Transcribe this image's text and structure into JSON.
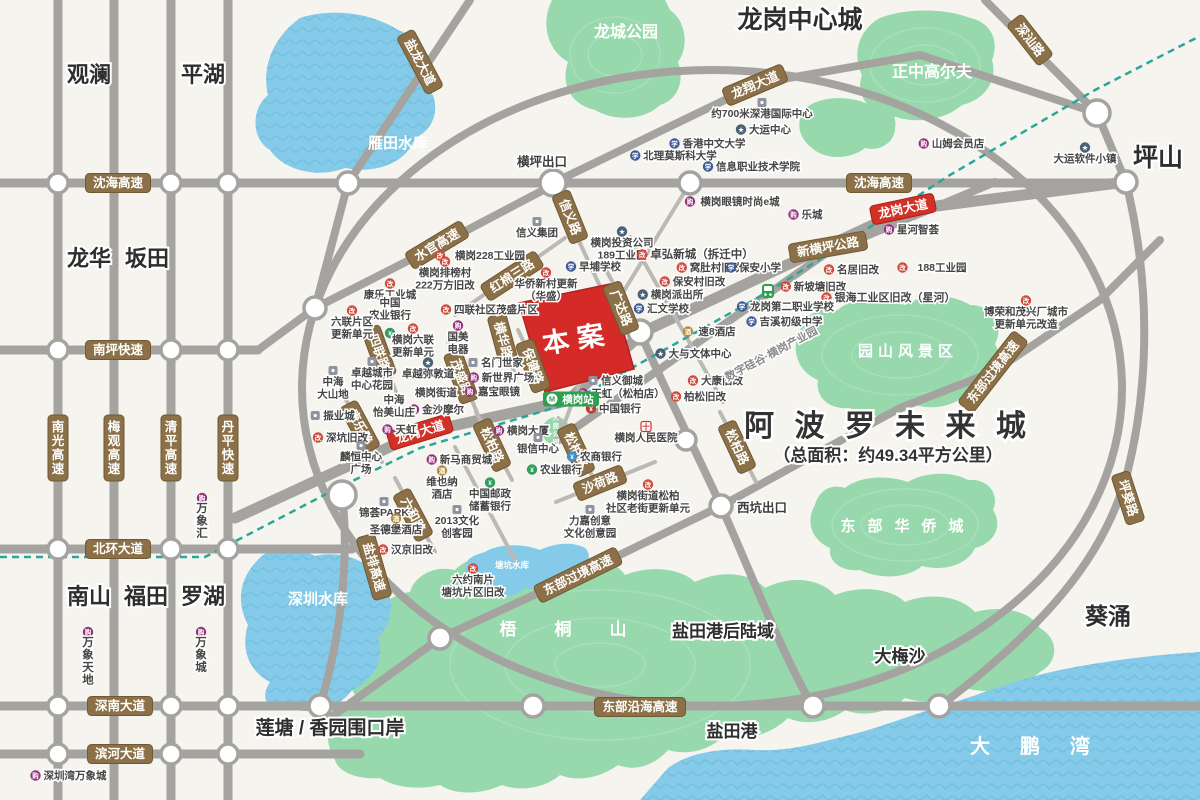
{
  "apollo": {
    "title": "阿 波 罗 未 来 城",
    "subtitle": "（总面积：约49.34平方公里）"
  },
  "site": {
    "label": "本案"
  },
  "station": {
    "label": "横岗站"
  },
  "districts": [
    {
      "t": "观澜",
      "x": 89,
      "y": 82,
      "fs": 22
    },
    {
      "t": "平湖",
      "x": 203,
      "y": 82,
      "fs": 22
    },
    {
      "t": "龙岗中心城",
      "x": 800,
      "y": 28,
      "fs": 25
    },
    {
      "t": "坪山",
      "x": 1158,
      "y": 166,
      "fs": 25
    },
    {
      "t": "龙华",
      "x": 89,
      "y": 266,
      "fs": 22
    },
    {
      "t": "坂田",
      "x": 147,
      "y": 266,
      "fs": 22
    },
    {
      "t": "南山",
      "x": 89,
      "y": 604,
      "fs": 22
    },
    {
      "t": "福田",
      "x": 146,
      "y": 604,
      "fs": 22
    },
    {
      "t": "罗湖",
      "x": 203,
      "y": 604,
      "fs": 22
    },
    {
      "t": "葵涌",
      "x": 1108,
      "y": 624,
      "fs": 23
    },
    {
      "t": "大梅沙",
      "x": 900,
      "y": 662,
      "fs": 17
    },
    {
      "t": "盐田港后陆域",
      "x": 723,
      "y": 637,
      "fs": 17
    },
    {
      "t": "盐田港",
      "x": 732,
      "y": 737,
      "fs": 17
    },
    {
      "t": "莲塘 / 香园围口岸",
      "x": 330,
      "y": 734,
      "fs": 19
    }
  ],
  "water_labels": [
    {
      "t": "雁田水库",
      "x": 398,
      "y": 148,
      "fs": 15
    },
    {
      "t": "深圳水库",
      "x": 318,
      "y": 604,
      "fs": 15
    },
    {
      "t": "塘坑水库",
      "x": 512,
      "y": 568,
      "fs": 8.5
    },
    {
      "t": "大鹏湾",
      "x": 1045,
      "y": 753,
      "fs": 20,
      "ls": 30
    }
  ],
  "park_labels": [
    {
      "t": "龙城公园",
      "x": 626,
      "y": 37,
      "fs": 16
    },
    {
      "t": "正中高尔夫",
      "x": 932,
      "y": 77,
      "fs": 16
    },
    {
      "t": "园山风景区",
      "x": 908,
      "y": 356,
      "fs": 15,
      "ls": 5
    },
    {
      "t": "东部华侨城",
      "x": 908,
      "y": 531,
      "fs": 15,
      "ls": 12
    },
    {
      "t": "梧桐山",
      "x": 582,
      "y": 635,
      "fs": 17,
      "ls": 38
    },
    {
      "t": "人民公园",
      "x": 556,
      "y": 420,
      "fs": 6.5,
      "vert": 1
    }
  ],
  "road_labels": [
    {
      "t": "沈海高速",
      "x": 118,
      "y": 183
    },
    {
      "t": "沈海高速",
      "x": 879,
      "y": 183
    },
    {
      "t": "南坪快速",
      "x": 118,
      "y": 350
    },
    {
      "t": "北环大道",
      "x": 118,
      "y": 549
    },
    {
      "t": "深南大道",
      "x": 120,
      "y": 706
    },
    {
      "t": "滨河大道",
      "x": 120,
      "y": 754
    },
    {
      "t": "东部沿海高速",
      "x": 640,
      "y": 707
    },
    {
      "t": "新横坪公路",
      "x": 828,
      "y": 247,
      "rot": -10
    },
    {
      "t": "盐龙大道",
      "x": 420,
      "y": 62,
      "rot": 62
    },
    {
      "t": "龙翔大道",
      "x": 755,
      "y": 85,
      "rot": -23
    },
    {
      "t": "深汕路",
      "x": 1030,
      "y": 40,
      "rot": 52
    },
    {
      "t": "水官高速",
      "x": 437,
      "y": 245,
      "rot": -31
    },
    {
      "t": "红棉三路",
      "x": 512,
      "y": 276,
      "rot": -33
    },
    {
      "t": "信义路",
      "x": 570,
      "y": 217,
      "rot": 68
    },
    {
      "t": "横华路",
      "x": 503,
      "y": 340,
      "rot": 75
    },
    {
      "t": "茂盛路",
      "x": 461,
      "y": 377,
      "rot": 70
    },
    {
      "t": "四联路",
      "x": 379,
      "y": 352,
      "rot": 70
    },
    {
      "t": "康乐路",
      "x": 360,
      "y": 427,
      "rot": 62
    },
    {
      "t": "六和路",
      "x": 413,
      "y": 515,
      "rot": 62
    },
    {
      "t": "保健路",
      "x": 533,
      "y": 366,
      "rot": 70
    },
    {
      "t": "广达路",
      "x": 621,
      "y": 308,
      "rot": 68
    },
    {
      "t": "松柏路",
      "x": 492,
      "y": 445,
      "rot": 65
    },
    {
      "t": "松柏路",
      "x": 576,
      "y": 450,
      "rot": 65
    },
    {
      "t": "松柏路",
      "x": 737,
      "y": 447,
      "rot": 65
    },
    {
      "t": "沙荷路",
      "x": 600,
      "y": 483,
      "rot": -22
    },
    {
      "t": "盐排高速",
      "x": 374,
      "y": 567,
      "rot": 74
    },
    {
      "t": "东部过境高速",
      "x": 578,
      "y": 575,
      "rot": -26
    },
    {
      "t": "东部过境高速",
      "x": 993,
      "y": 372,
      "rot": -52
    },
    {
      "t": "坪葵路",
      "x": 1128,
      "y": 498,
      "rot": 72
    },
    {
      "t": "南光高速",
      "x": 58,
      "y": 448,
      "v": 1
    },
    {
      "t": "梅观高速",
      "x": 114,
      "y": 448,
      "v": 1
    },
    {
      "t": "清平高速",
      "x": 171,
      "y": 448,
      "v": 1
    },
    {
      "t": "丹平快速",
      "x": 228,
      "y": 448,
      "v": 1
    },
    {
      "t": "龙岗大道",
      "x": 420,
      "y": 432,
      "rot": -17,
      "style": "red"
    },
    {
      "t": "龙岗大道",
      "x": 903,
      "y": 209,
      "rot": -12,
      "style": "red"
    }
  ],
  "exits": [
    {
      "t": "横坪出口",
      "x": 542,
      "y": 166
    },
    {
      "t": "西坑出口",
      "x": 762,
      "y": 512
    }
  ],
  "pois": [
    {
      "x": 762,
      "y": 117,
      "t": "约700米深港国际中心",
      "icon": "building",
      "ic": "a"
    },
    {
      "x": 770,
      "y": 133,
      "t": "大运中心",
      "icon": "spot"
    },
    {
      "x": 714,
      "y": 147,
      "t": "香港中文大学",
      "icon": "school"
    },
    {
      "x": 680,
      "y": 159,
      "t": "北理莫斯科大学",
      "icon": "school"
    },
    {
      "x": 758,
      "y": 170,
      "t": "信息职业技术学院",
      "icon": "school"
    },
    {
      "x": 740,
      "y": 205,
      "t": "横岗眼镜时尚e城",
      "icon": "mall"
    },
    {
      "x": 812,
      "y": 218,
      "t": "乐城",
      "icon": "mall"
    },
    {
      "x": 918,
      "y": 233,
      "t": "星河智荟",
      "icon": "mall"
    },
    {
      "x": 958,
      "y": 147,
      "t": "山姆会员店",
      "icon": "mall"
    },
    {
      "x": 1085,
      "y": 162,
      "t": "大运软件小镇",
      "icon": "spot",
      "ic": "a"
    },
    {
      "x": 1026,
      "y": 315,
      "lines": [
        "博荣和茂兴厂城市",
        "更新单元改造"
      ],
      "icon": "redev",
      "ic": "a"
    },
    {
      "x": 537,
      "y": 236,
      "t": "信义集团",
      "icon": "building",
      "ic": "a"
    },
    {
      "x": 622,
      "y": 246,
      "lines": [
        "横岗投资公司",
        "189工业区"
      ],
      "icon": "spot",
      "ic": "a"
    },
    {
      "x": 702,
      "y": 258,
      "t": "卓弘新城（拆迁中）",
      "fs": 11.5,
      "icon": "redev"
    },
    {
      "x": 490,
      "y": 259,
      "t": "横岗228工业园",
      "icon": "redev"
    },
    {
      "x": 600,
      "y": 270,
      "t": "早埔学校",
      "icon": "school"
    },
    {
      "x": 716,
      "y": 271,
      "t": "窝肚村旧改",
      "icon": "redev"
    },
    {
      "x": 445,
      "y": 276,
      "lines": [
        "横岗排榜村",
        "222万方旧改"
      ],
      "icon": "redev",
      "ic": "a"
    },
    {
      "x": 760,
      "y": 271,
      "t": "保安小学",
      "icon": "school"
    },
    {
      "x": 699,
      "y": 285,
      "t": "保安村旧改",
      "icon": "redev"
    },
    {
      "x": 858,
      "y": 273,
      "t": "名居旧改",
      "icon": "redev"
    },
    {
      "x": 942,
      "y": 271,
      "t": "188工业园",
      "icon": "redev"
    },
    {
      "x": 390,
      "y": 298,
      "t": "康乐工业城",
      "icon": "redev",
      "ic": "a"
    },
    {
      "x": 390,
      "y": 306,
      "lines": [
        "中国",
        "农业银行"
      ],
      "icon": "bank-green",
      "ic": "b"
    },
    {
      "x": 352,
      "y": 325,
      "lines": [
        "六联片区",
        "更新单元"
      ],
      "icon": "redev",
      "ic": "a"
    },
    {
      "x": 413,
      "y": 343,
      "lines": [
        "横岗六联",
        "更新单元"
      ],
      "icon": "redev",
      "ic": "a"
    },
    {
      "x": 496,
      "y": 313,
      "t": "四联社区茂盛片区",
      "icon": "redev"
    },
    {
      "x": 546,
      "y": 287,
      "lines": [
        "华侨新村更新",
        "（华盛）"
      ],
      "icon": "redev",
      "ic": "a"
    },
    {
      "x": 458,
      "y": 340,
      "lines": [
        "国美",
        "电器"
      ],
      "icon": "mall",
      "ic": "a"
    },
    {
      "x": 502,
      "y": 366,
      "t": "名门世家",
      "icon": "building"
    },
    {
      "x": 508,
      "y": 381,
      "t": "新世界广场",
      "icon": "mall"
    },
    {
      "x": 499,
      "y": 395,
      "t": "嘉宝眼镜",
      "icon": "mall"
    },
    {
      "x": 372,
      "y": 376,
      "lines": [
        "卓越城市",
        "中心花园"
      ],
      "icon": "building",
      "ic": "a"
    },
    {
      "x": 333,
      "y": 385,
      "lines": [
        "中海",
        "大山地"
      ],
      "icon": "building",
      "ic": "a"
    },
    {
      "x": 428,
      "y": 377,
      "t": "卓越弥敦道",
      "icon": "spot",
      "ic": "a"
    },
    {
      "x": 436,
      "y": 396,
      "t": "横岗街道",
      "icon": "none",
      "fs": 10.5
    },
    {
      "x": 443,
      "y": 413,
      "t": "金沙摩尔",
      "icon": "mall"
    },
    {
      "x": 394,
      "y": 403,
      "lines": [
        "中海",
        "怡美山庄"
      ],
      "icon": "none",
      "fs": 10.5
    },
    {
      "x": 339,
      "y": 419,
      "t": "振业城",
      "icon": "building"
    },
    {
      "x": 347,
      "y": 441,
      "t": "深坑旧改",
      "icon": "redev"
    },
    {
      "x": 406,
      "y": 433,
      "t": "天虹",
      "icon": "mall"
    },
    {
      "x": 361,
      "y": 460,
      "lines": [
        "麟恒中心",
        "广场"
      ],
      "icon": "building",
      "ic": "a"
    },
    {
      "x": 384,
      "y": 516,
      "t": "锦荟PARK",
      "icon": "building",
      "ic": "a"
    },
    {
      "x": 396,
      "y": 533,
      "t": "圣德堡酒店",
      "icon": "hotel",
      "ic": "a"
    },
    {
      "x": 412,
      "y": 553,
      "t": "汉京旧改",
      "icon": "redev"
    },
    {
      "x": 457,
      "y": 524,
      "lines": [
        "2013文化",
        "创客园"
      ],
      "icon": "building",
      "ic": "a"
    },
    {
      "x": 466,
      "y": 463,
      "t": "新马商贸城",
      "icon": "mall"
    },
    {
      "x": 442,
      "y": 485,
      "lines": [
        "维也纳",
        "酒店"
      ],
      "icon": "hotel",
      "ic": "a"
    },
    {
      "x": 490,
      "y": 497,
      "lines": [
        "中国邮政",
        "储蓄银行"
      ],
      "icon": "bank-green",
      "ic": "a"
    },
    {
      "x": 528,
      "y": 434,
      "t": "横岗大厦",
      "icon": "mall"
    },
    {
      "x": 538,
      "y": 452,
      "t": "银信中心",
      "icon": "building",
      "ic": "a"
    },
    {
      "x": 601,
      "y": 460,
      "t": "农商银行",
      "icon": "bank-blue"
    },
    {
      "x": 561,
      "y": 473,
      "t": "农业银行",
      "icon": "bank-green"
    },
    {
      "x": 646,
      "y": 441,
      "t": "横岗人民医院",
      "icon": "hospital",
      "ic": "a"
    },
    {
      "x": 648,
      "y": 499,
      "lines": [
        "横岗街道松柏",
        "社区老街更新单元"
      ],
      "icon": "redev",
      "ic": "a"
    },
    {
      "x": 590,
      "y": 524,
      "lines": [
        "力嘉创意",
        "文化创意园"
      ],
      "icon": "building",
      "ic": "a"
    },
    {
      "x": 622,
      "y": 384,
      "t": "信义御城",
      "icon": "building"
    },
    {
      "x": 628,
      "y": 397,
      "t": "天虹（松柏店）",
      "icon": "mall"
    },
    {
      "x": 620,
      "y": 412,
      "t": "中国银行",
      "icon": "bank-red"
    },
    {
      "x": 717,
      "y": 335,
      "t": "速8酒店",
      "icon": "hotel"
    },
    {
      "x": 700,
      "y": 357,
      "t": "大与文体中心",
      "icon": "spot"
    },
    {
      "x": 722,
      "y": 384,
      "t": "大康旧改",
      "icon": "redev"
    },
    {
      "x": 705,
      "y": 400,
      "t": "柏松旧改",
      "icon": "redev"
    },
    {
      "x": 677,
      "y": 298,
      "t": "横岗派出所",
      "icon": "spot"
    },
    {
      "x": 668,
      "y": 312,
      "t": "汇文学校",
      "icon": "school"
    },
    {
      "x": 820,
      "y": 290,
      "t": "新坡塘旧改",
      "icon": "redev"
    },
    {
      "x": 895,
      "y": 301,
      "t": "银海工业区旧改（星河）",
      "icon": "redev",
      "fs": 11
    },
    {
      "x": 792,
      "y": 310,
      "t": "龙岗第二职业学校",
      "icon": "school"
    },
    {
      "x": 791,
      "y": 325,
      "t": "吉溪初级中学",
      "icon": "school"
    },
    {
      "x": 773,
      "y": 357,
      "t": "数字硅谷·横岗产业园",
      "icon": "none",
      "rot": -28,
      "muted": 1,
      "fs": 11
    },
    {
      "x": 473,
      "y": 583,
      "lines": [
        "六约南片",
        "塘坑片区旧改"
      ],
      "icon": "redev",
      "ic": "a"
    },
    {
      "x": 202,
      "y": 512,
      "lines": [
        "万象汇"
      ],
      "icon": "mall",
      "vert": 1
    },
    {
      "x": 88,
      "y": 646,
      "lines": [
        "万象天地"
      ],
      "icon": "mall",
      "vert": 1
    },
    {
      "x": 201,
      "y": 646,
      "lines": [
        "万象城"
      ],
      "icon": "mall",
      "vert": 1
    },
    {
      "x": 75,
      "y": 779,
      "t": "深圳湾万象城",
      "icon": "mall"
    }
  ],
  "icons": {
    "redev": {
      "color": "#cf4a3c",
      "glyph": "改"
    },
    "school": {
      "color": "#3d5a96",
      "glyph": "学"
    },
    "spot": {
      "color": "#4a6076",
      "glyph": "★"
    },
    "mall": {
      "color": "#95307d",
      "glyph": "购"
    },
    "bank-green": {
      "color": "#2f9e5f",
      "glyph": "¥"
    },
    "bank-blue": {
      "color": "#3e8fc9",
      "glyph": "¥"
    },
    "bank-red": {
      "color": "#c43b35",
      "glyph": "¥"
    },
    "hotel": {
      "color": "#b08d3e",
      "glyph": "酒"
    },
    "building": {
      "color": "#8d94a0",
      "glyph": "■"
    },
    "hospital": {
      "color": "#ffffff",
      "glyph": "十"
    }
  },
  "colors": {
    "bg": "#f6f4ee",
    "road": "#a5a3a0",
    "road_minor": "#bcb9b4",
    "water": "#85cbe9",
    "water_line": "#68b7d8",
    "park": "#97d8ac",
    "park_line": "#abe0bf",
    "metro": "#2aa79a",
    "plate": "#8c7148",
    "plate_red": "#d23127",
    "site_red": "#d42a28",
    "station_green": "#2e9e4f",
    "poi_text": "#454545",
    "district_text": "#2e2e2e"
  }
}
